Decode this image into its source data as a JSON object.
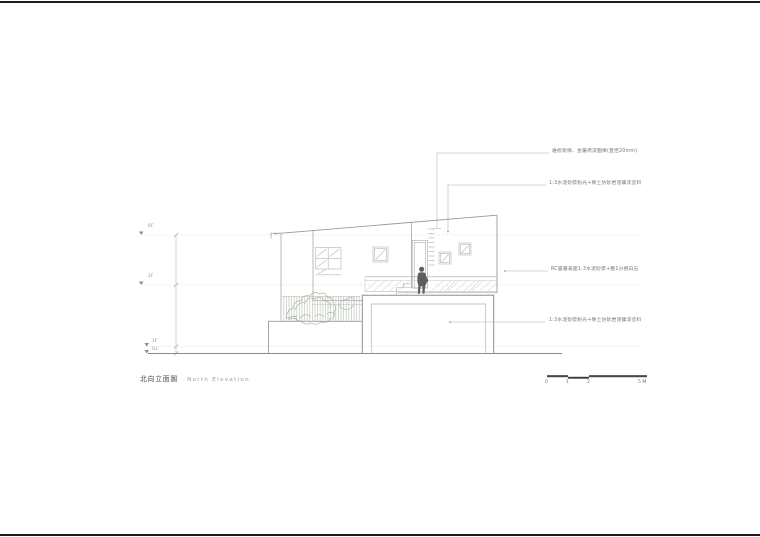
{
  "title": {
    "zh": "北向立面圖",
    "en": "North Elevation"
  },
  "levels": [
    {
      "label": "RF"
    },
    {
      "label": "2F"
    },
    {
      "label": "1F"
    },
    {
      "label": "GL"
    }
  ],
  "annotations": [
    {
      "text": "維修爬梯．金屬烤漆圓棒(直徑20mm)"
    },
    {
      "text": "1:3水泥砂漿粉光+樂土仿砂岩泥礦漆塗料"
    },
    {
      "text": "RC露臺表面1:3水泥砂漿+壓1分抿白石"
    },
    {
      "text": "1:3水泥砂漿粉光+樂土仿砂岩泥礦漆塗料"
    }
  ],
  "scale_bar": {
    "ticks": [
      "0",
      "1",
      "2"
    ],
    "end_label": "5 M"
  },
  "colors": {
    "sheet_border": "#1c1c1c",
    "line_light": "#c4c4c4",
    "line_mid": "#9a9a9a",
    "line_dark": "#6f6f6f",
    "plant_green": "#9fae92",
    "figure_gray": "#5d5d5d"
  }
}
